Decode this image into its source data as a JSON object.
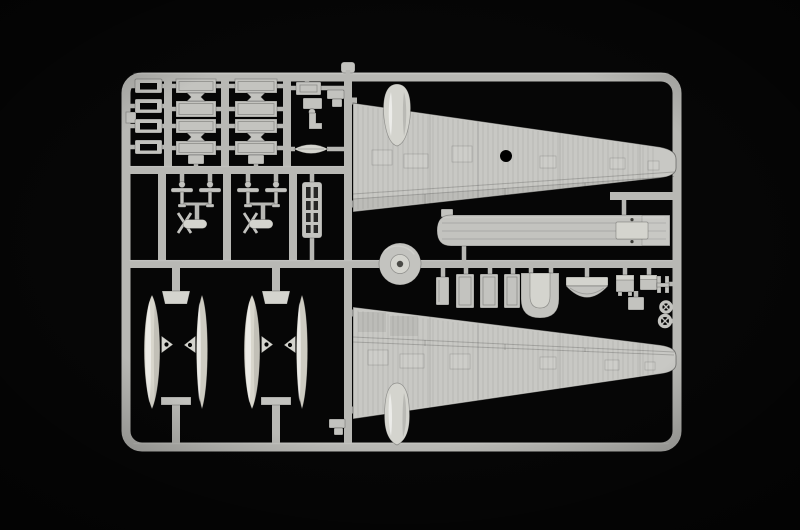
{
  "scene": {
    "subject": "Light grey injection-moulded model aircraft sprue photographed on a black background",
    "style": "studio product photo, soft overhead lighting, slight corner vignette",
    "content": "Parts tree of a trimotor floatplane kit: two corrugated wing halves with engine nacelle fairings, four seaplane float halves, a long cabin floor, stacked bulkhead panels and many small detail parts"
  },
  "colors": {
    "bg": "#060606",
    "plastic": "#b8b8b4",
    "part": "#c3c3bf",
    "part-light": "#d4d4ce",
    "bright": "#eae8de",
    "wing": "#c8c8c4",
    "float-main": "#d8d6cc",
    "float-alt": "#cdcbc1",
    "hole": "#000000"
  },
  "parts": [
    {
      "name": "upper-wing-half",
      "count": 1,
      "location": "top right",
      "features": "corrugated skin, engine nacelle bump, round locating hole"
    },
    {
      "name": "lower-wing-half",
      "count": 1,
      "location": "bottom right",
      "features": "corrugated skin, engine nacelle bump"
    },
    {
      "name": "float-half",
      "count": 4,
      "location": "bottom left in two framed bays",
      "features": "elongated pontoon halves with mid fins and rigging holes"
    },
    {
      "name": "cabin-floor",
      "count": 1,
      "location": "middle right",
      "features": "long plank, end bulkhead plate, two locating holes"
    },
    {
      "name": "hollow-hatch-frame",
      "count": 4,
      "location": "far left column"
    },
    {
      "name": "bulkhead-panel",
      "count": 8,
      "location": "top left, two columns of four"
    },
    {
      "name": "bowtie-connector",
      "count": 4,
      "location": "between stacked panels"
    },
    {
      "name": "control-mast",
      "count": 4,
      "location": "mid left row"
    },
    {
      "name": "finned-engine-pod",
      "count": 2,
      "location": "mid left row"
    },
    {
      "name": "ladder-frame",
      "count": 1,
      "location": "mid left"
    },
    {
      "name": "oval-fairing",
      "count": 1,
      "location": "upper middle column"
    },
    {
      "name": "small-bracket",
      "count": 3,
      "location": "upper middle and near wing roots"
    },
    {
      "name": "wheel-drum-disc",
      "count": 1,
      "location": "center of sprue on runner"
    },
    {
      "name": "interior-panel",
      "count": 4,
      "location": "row below cabin floor"
    },
    {
      "name": "u-channel-cowl",
      "count": 1,
      "location": "row below cabin floor"
    },
    {
      "name": "dome-cowl-front",
      "count": 1,
      "location": "row below cabin floor"
    },
    {
      "name": "engine-block",
      "count": 2,
      "location": "row below cabin floor, right"
    },
    {
      "name": "small-plate",
      "count": 1,
      "location": "row below cabin floor, right"
    },
    {
      "name": "h-clip",
      "count": 1,
      "location": "right edge"
    },
    {
      "name": "spoked-pulley",
      "count": 2,
      "location": "right edge"
    }
  ]
}
